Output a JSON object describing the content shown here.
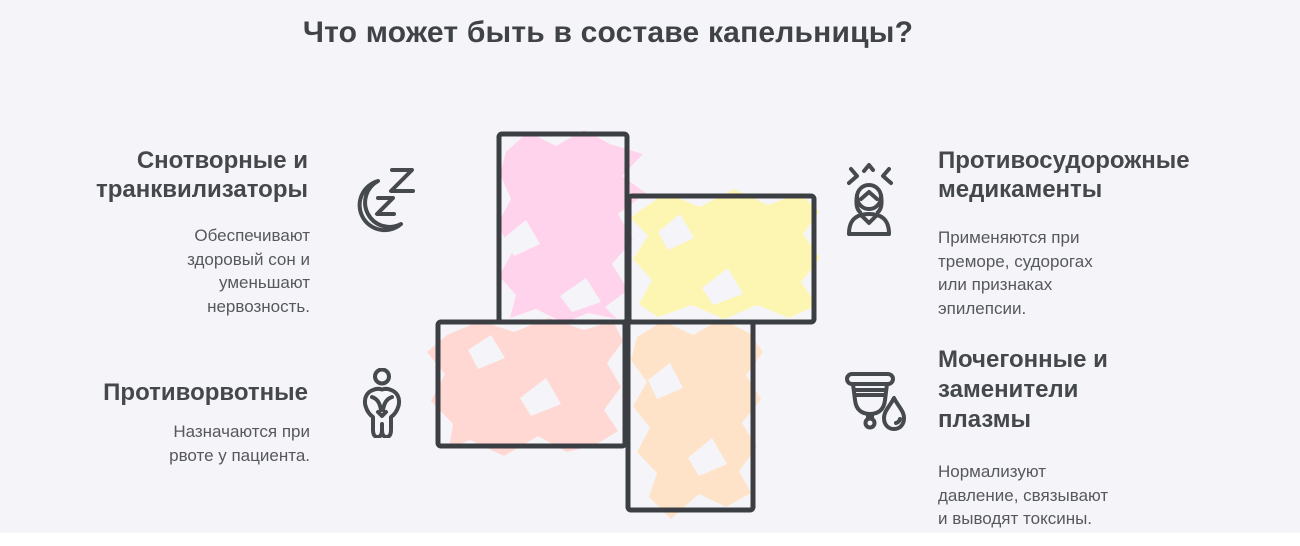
{
  "title": "Что может быть в составе капельницы?",
  "colors": {
    "background": "#f5f5f9",
    "outline": "#3b3e42",
    "heading_text": "#44474b",
    "body_text": "#55585c",
    "pink": "#ffd3ec",
    "yellow": "#fdf6b2",
    "salmon": "#ffd7d3",
    "orange": "#ffe3c9"
  },
  "sections": {
    "sleep": {
      "heading": [
        "Снотворные и",
        "транквилизаторы"
      ],
      "description": [
        "Обеспечивают",
        "здоровый сон и",
        "уменьшают",
        "нервозность."
      ],
      "icon": "moon-zzz-icon"
    },
    "anticonvulsant": {
      "heading": [
        "Противосудорожные",
        "медикаменты"
      ],
      "description": [
        "Применяются при",
        "треморе, судорогах",
        "или признаках",
        "эпилепсии."
      ],
      "icon": "tremor-person-icon"
    },
    "antiemetic": {
      "heading": [
        "Противорвотные"
      ],
      "description": [
        "Назначаются при",
        "рвоте у пациента."
      ],
      "icon": "nausea-person-icon"
    },
    "diuretic": {
      "heading": [
        "Мочегонные и",
        "заменители",
        "плазмы"
      ],
      "description": [
        "Нормализуют",
        "давление, связывают",
        "и выводят токсины."
      ],
      "icon": "cup-droplet-icon"
    }
  },
  "pinwheel": {
    "outline_color": "#3b3e42",
    "blocks": [
      {
        "name": "top-vertical-block",
        "color": "#ffd3ec"
      },
      {
        "name": "right-horizontal-block",
        "color": "#fdf6b2"
      },
      {
        "name": "left-horizontal-block",
        "color": "#ffd7d3"
      },
      {
        "name": "bottom-vertical-block",
        "color": "#ffe3c9"
      }
    ]
  }
}
